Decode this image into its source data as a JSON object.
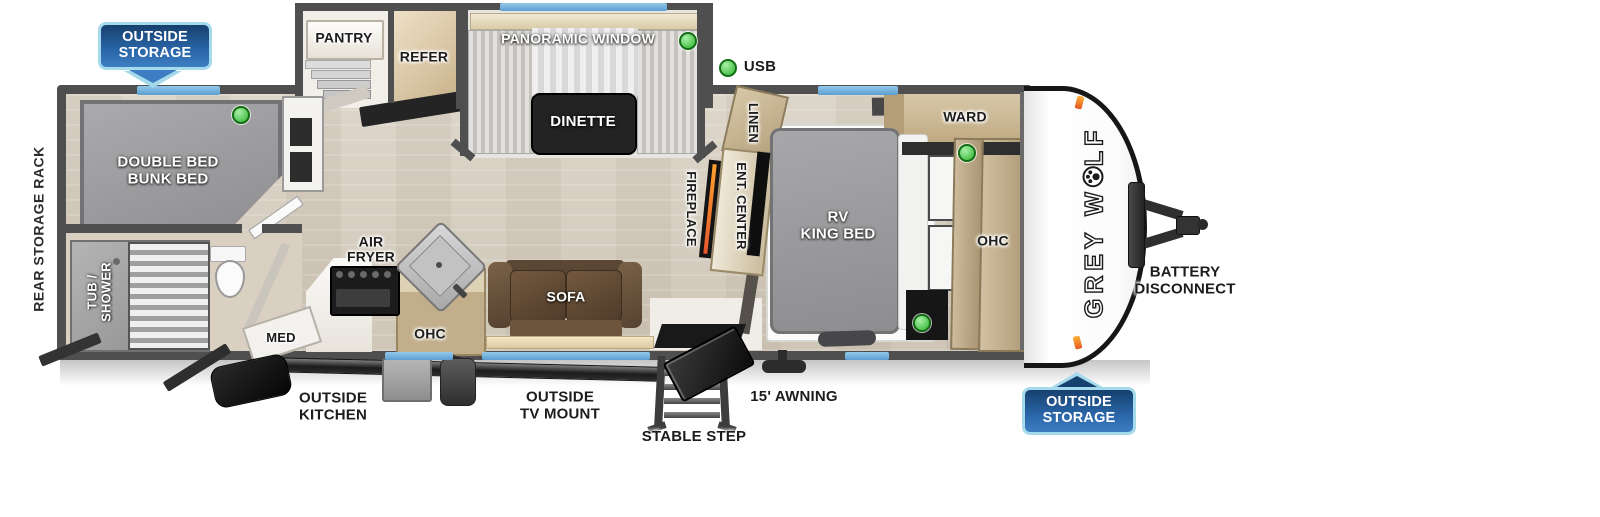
{
  "trailer": {
    "brand": {
      "full": "GREY WOLF",
      "prefix": "GREY W",
      "suffix": "LF"
    },
    "banners": {
      "top_left": "OUTSIDE\nSTORAGE",
      "bottom_right": "OUTSIDE\nSTORAGE"
    },
    "exterior_labels": {
      "rear_storage_rack": "REAR STORAGE RACK",
      "battery_disconnect": "BATTERY\nDISCONNECT",
      "awning": "15' AWNING",
      "stable_step": "STABLE STEP",
      "outside_tv_mount": "OUTSIDE\nTV MOUNT",
      "outside_kitchen": "OUTSIDE\nKITCHEN",
      "usb": "USB"
    },
    "rooms": {
      "bunk": {
        "bed": "DOUBLE BED\nBUNK BED"
      },
      "bath": {
        "tub_shower": "TUB /\nSHOWER",
        "med": "MED"
      },
      "kitchen": {
        "pantry": "PANTRY",
        "refer": "REFER",
        "air_fryer": "AIR\nFRYER",
        "ohc": "OHC"
      },
      "living": {
        "panoramic_window": "PANORAMIC WINDOW",
        "dinette": "DINETTE",
        "sofa": "SOFA"
      },
      "center": {
        "linen": "LINEN",
        "ent_center": "ENT. CENTER",
        "fireplace": "FIREPLACE"
      },
      "bedroom": {
        "bed": "RV\nKING BED",
        "ward": "WARD",
        "ohc": "OHC"
      }
    },
    "colors": {
      "wall": "#4f4f4f",
      "window_blue": "#6fb0dc",
      "banner_blue": "#2a66a8",
      "banner_border": "#a5d9ec",
      "green_dot": "#2db32d",
      "clearance_orange": "#f08a2a"
    }
  }
}
